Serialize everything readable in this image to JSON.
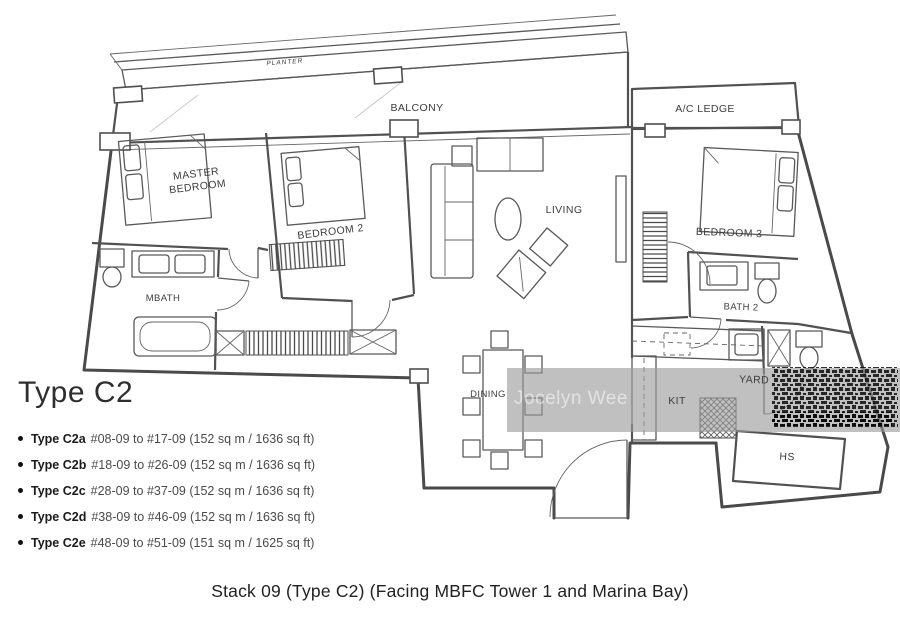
{
  "plan": {
    "labels": {
      "planter": "PLANTER",
      "balcony": "BALCONY",
      "ac_ledge": "A/C LEDGE",
      "master_bedroom_line1": "MASTER",
      "master_bedroom_line2": "BEDROOM",
      "bedroom2": "BEDROOM 2",
      "living": "LIVING",
      "bedroom3": "BEDROOM 3",
      "mbath": "MBATH",
      "bath2": "BATH 2",
      "dining": "DINING",
      "kitchen": "KIT",
      "yard": "YARD",
      "hs": "HS"
    },
    "watermark": "Jocelyn Wee"
  },
  "legend": {
    "title": "Type C2",
    "items": [
      {
        "name": "Type C2a",
        "details": "#08-09 to #17-09 (152 sq m / 1636 sq ft)"
      },
      {
        "name": "Type C2b",
        "details": "#18-09 to #26-09 (152 sq m / 1636 sq ft)"
      },
      {
        "name": "Type C2c",
        "details": "#28-09 to #37-09 (152 sq m / 1636 sq ft)"
      },
      {
        "name": "Type C2d",
        "details": "#38-09 to #46-09 (152 sq m / 1636 sq ft)"
      },
      {
        "name": "Type C2e",
        "details": "#48-09 to #51-09 (151 sq m / 1625 sq ft)"
      }
    ]
  },
  "caption": "Stack 09 (Type C2) (Facing MBFC Tower 1 and Marina Bay)"
}
